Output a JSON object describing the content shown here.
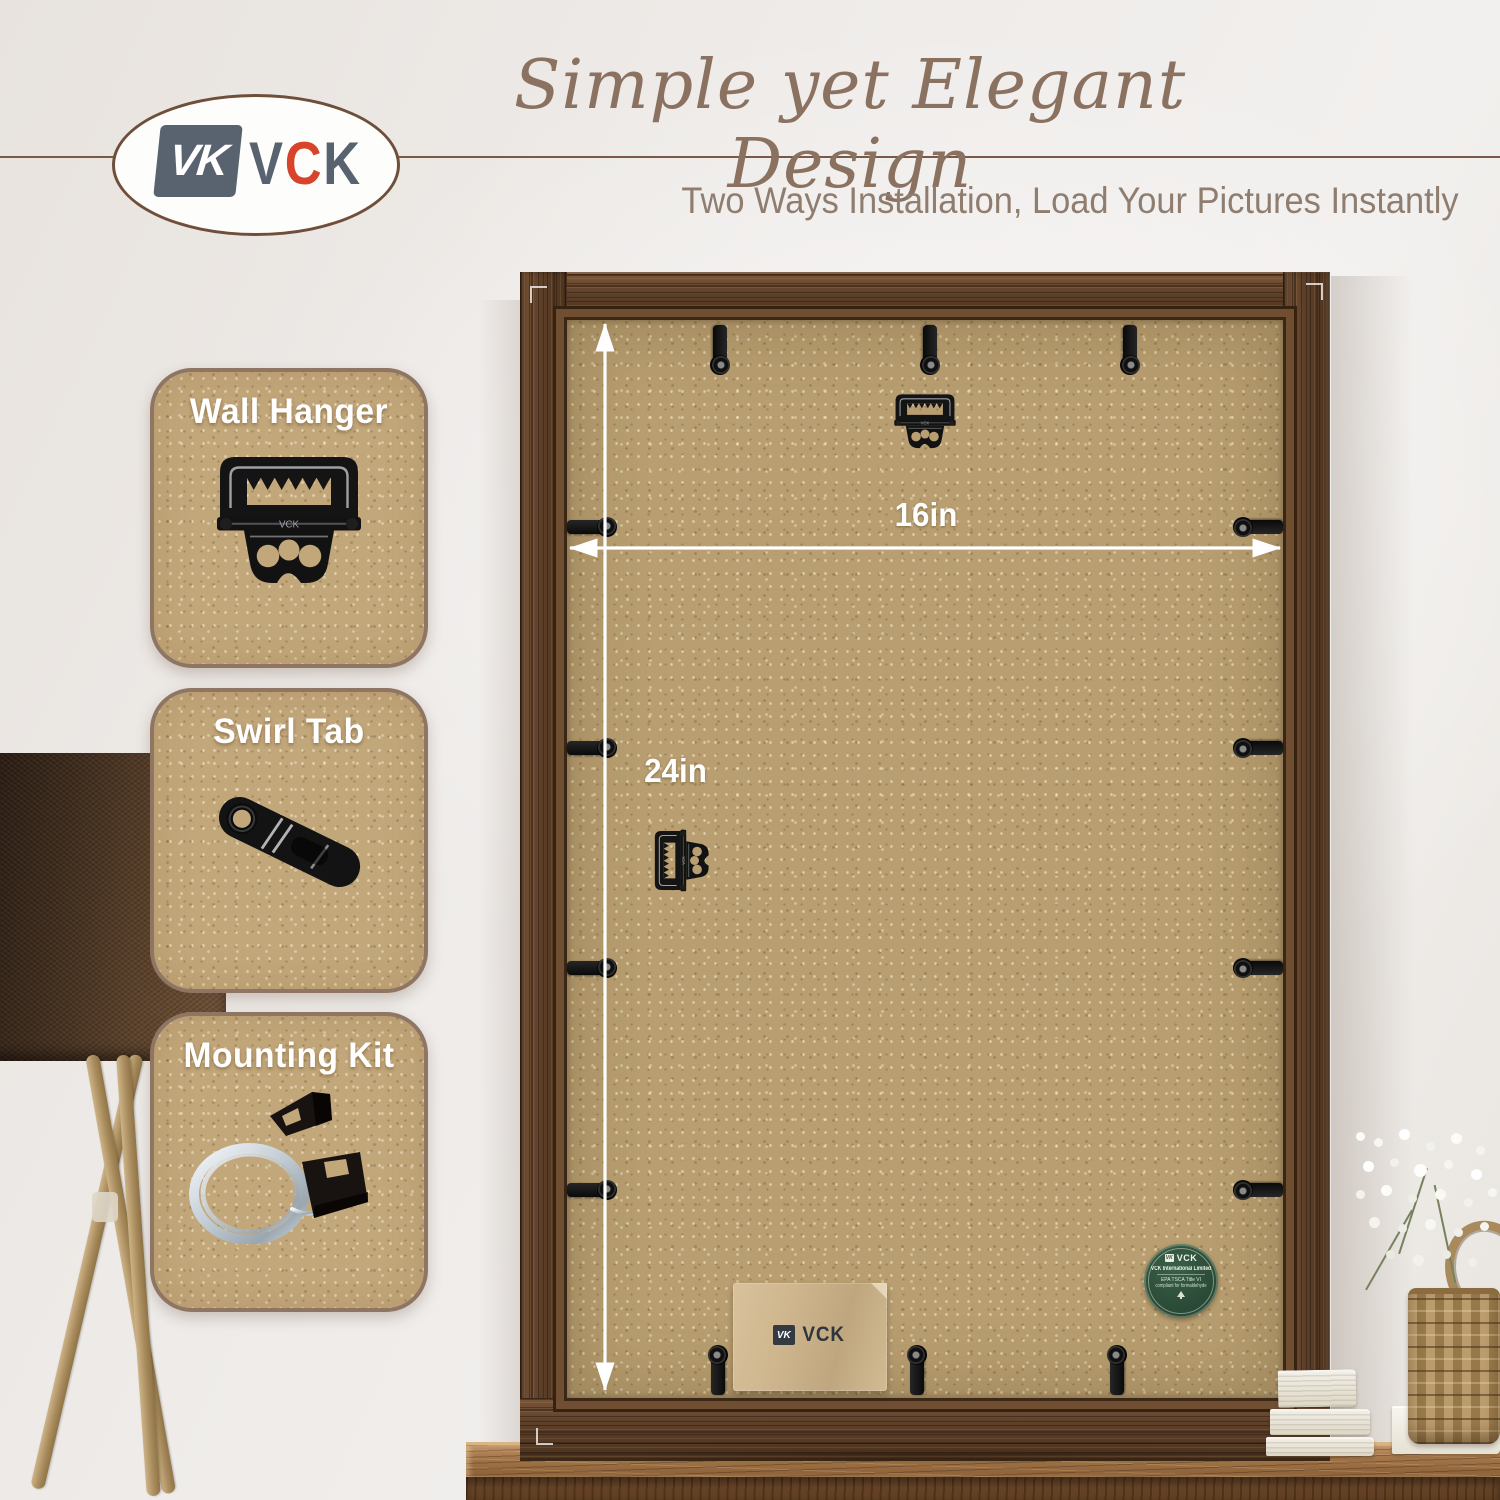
{
  "logo": {
    "brand": "VCK",
    "monogram": "VK",
    "letters": [
      "V",
      "C",
      "K"
    ]
  },
  "header": {
    "title": "Simple yet Elegant Design",
    "subtitle": "Two Ways Installation, Load Your Pictures Instantly"
  },
  "callouts": [
    {
      "label": "Wall Hanger",
      "icon": "sawtooth-wall-hanger"
    },
    {
      "label": "Swirl Tab",
      "icon": "swirl-tab"
    },
    {
      "label": "Mounting Kit",
      "icon": "hanging-wire-and-clips"
    }
  ],
  "dimensions": {
    "width": "16in",
    "height": "24in"
  },
  "hardware": {
    "stamp": "VCK"
  },
  "pouch": {
    "brand": "VCK"
  },
  "sticker": {
    "brand": "VCK",
    "org": "VCK International Limited",
    "cert_line1": "EPA TSCA Title VI",
    "cert_line2": "compliant for formaldehyde"
  },
  "colors": {
    "accent_red": "#d8432b",
    "logo_slate": "#59626f",
    "title_brown": "#8b7160",
    "card_tan": "#c2a77b",
    "frame_wood": "#5e4129",
    "board_tan": "#b89e70",
    "sticker_green": "#2b4c38",
    "arrow_white": "#ffffff"
  }
}
